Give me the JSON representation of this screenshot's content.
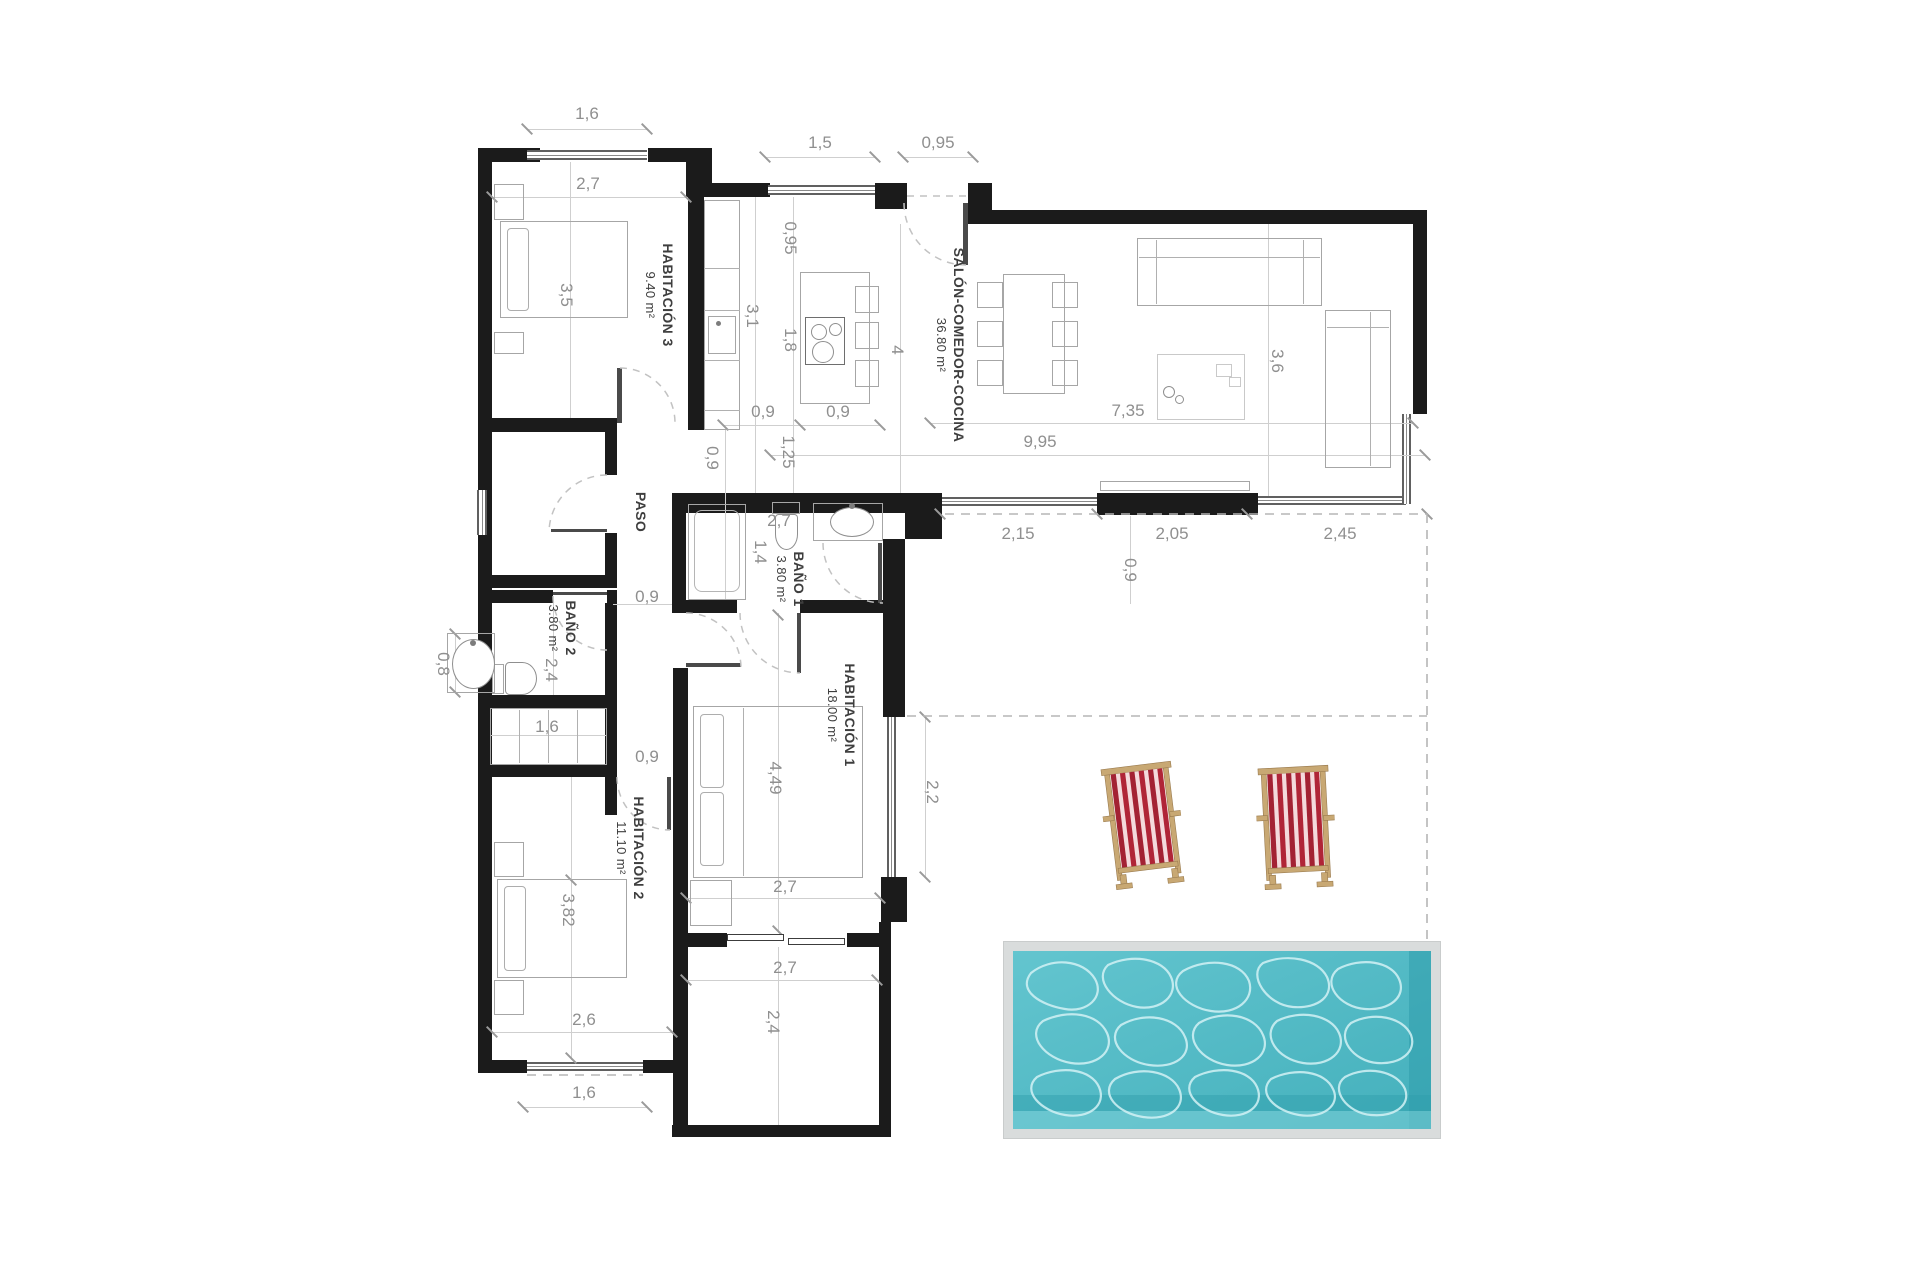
{
  "rooms": [
    {
      "name": "HABITACIÓN 3",
      "area": "9.40 m²"
    },
    {
      "name": "SALÓN-COMEDOR-COCINA",
      "area": "36.80 m²"
    },
    {
      "name": "PASO",
      "area": ""
    },
    {
      "name": "BAÑO 1",
      "area": "3.80 m²"
    },
    {
      "name": "BAÑO 2",
      "area": "3.80 m²"
    },
    {
      "name": "HABITACIÓN 1",
      "area": "18.00 m²"
    },
    {
      "name": "HABITACIÓN 2",
      "area": "11.10 m²"
    }
  ],
  "dims": {
    "win_hab3_top": "1,6",
    "hab3_width": "2,7",
    "hab3_height": "3,5",
    "kitchen_window": "1,5",
    "entry_opening": "0,95",
    "kitchen_offset": "0,95",
    "counter_length": "3,1",
    "island_length": "1,8",
    "salon_depth": "4",
    "island_w_left": "0,9",
    "island_w_right": "0,9",
    "salon_height": "3,6",
    "salon_width": "7,35",
    "total_width": "9,95",
    "pass_125": "1,25",
    "pass_09": "0,9",
    "bano1_width": "2,7",
    "bano1_height": "1,4",
    "facade_1": "2,15",
    "facade_2": "2,05",
    "facade_3": "2,45",
    "terrace_door": "0,9",
    "paso_door": "0,9",
    "alcove_08": "0,8",
    "bano2_height": "2,4",
    "closet_16": "1,6",
    "hab2_door": "0,9",
    "hab1_height": "4,49",
    "hab1_window": "2,2",
    "hab2_bed": "3,82",
    "hab1_width": "2,7",
    "hab2_width": "2,6",
    "porch_width": "2,7",
    "porch_height": "2,4",
    "hab2_window": "1,6"
  },
  "colors": {
    "wall": "#1b1b1b",
    "dim_text": "#8f8f8f",
    "room_text": "#3e3e3e",
    "pool_water": "#4fbac6",
    "pool_frame": "#d9dcdc",
    "chair_red": "#b02537",
    "chair_frame": "#c8a873"
  }
}
